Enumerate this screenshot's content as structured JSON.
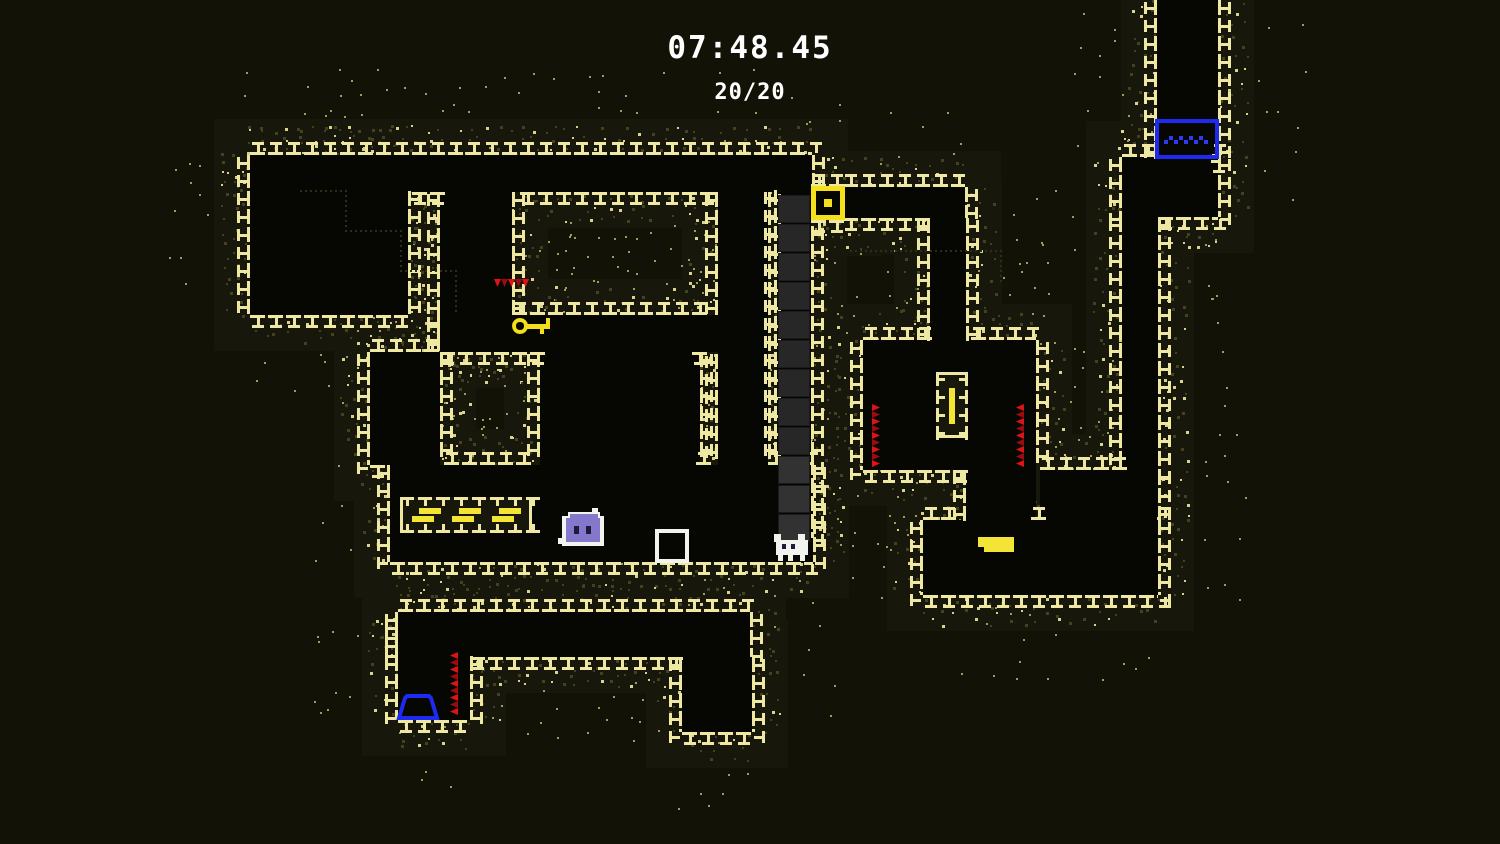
{
  "hud": {
    "timer": "07:48.45",
    "counter": "20/20"
  },
  "palette": {
    "bg": "#121207",
    "wall_fill": "#17170b",
    "room": "#060603",
    "brick": "#efe8a2",
    "dot_dim": "#424220",
    "dot_bright": "#d9d28c",
    "dot_outer": "#a29b5e",
    "accent_yellow": "#f4df1c",
    "bright_yellow": "#f4e435",
    "spike_red": "#dd1414",
    "spike_red_dark": "#9c0c0c",
    "blue": "#1c2af2",
    "blue_light": "#2b3cf4",
    "slime_purple": "#8478cc",
    "slime_eye": "#1c1c3a",
    "white": "#f2f2ee",
    "gray_block": "#272727",
    "gray_block_light": "#323232",
    "gray_block_edge": "#1a1a1a",
    "trail": "#2e2e16"
  },
  "render": {
    "width": 1500,
    "height": 844,
    "wall_margin": 36,
    "tile": 18,
    "seed": 7
  },
  "map": {
    "rooms": [
      {
        "name": "top-corridor",
        "x": 250,
        "y": 155,
        "w": 562,
        "h": 37
      },
      {
        "name": "top-left-room",
        "x": 250,
        "y": 155,
        "w": 158,
        "h": 160
      },
      {
        "name": "inner-corridor-down",
        "x": 440,
        "y": 192,
        "w": 72,
        "h": 160
      },
      {
        "name": "key-corridor",
        "x": 440,
        "y": 315,
        "w": 285,
        "h": 37
      },
      {
        "name": "center-room",
        "x": 540,
        "y": 352,
        "w": 160,
        "h": 113
      },
      {
        "name": "right-inner-corridor",
        "x": 718,
        "y": 192,
        "w": 50,
        "h": 273
      },
      {
        "name": "left-connector",
        "x": 370,
        "y": 352,
        "w": 70,
        "h": 113
      },
      {
        "name": "main-hall",
        "x": 390,
        "y": 465,
        "w": 423,
        "h": 97
      },
      {
        "name": "gray-shaft",
        "x": 777,
        "y": 190,
        "w": 34,
        "h": 348
      },
      {
        "name": "door-gap",
        "x": 811,
        "y": 187,
        "w": 34,
        "h": 33
      },
      {
        "name": "door-corridor",
        "x": 843,
        "y": 187,
        "w": 122,
        "h": 31
      },
      {
        "name": "down-shaft",
        "x": 930,
        "y": 218,
        "w": 36,
        "h": 125
      },
      {
        "name": "mid-right-room",
        "x": 863,
        "y": 340,
        "w": 173,
        "h": 130
      },
      {
        "name": "step-passage",
        "x": 966,
        "y": 470,
        "w": 70,
        "h": 73
      },
      {
        "name": "lower-corridor",
        "x": 398,
        "y": 612,
        "w": 352,
        "h": 45
      },
      {
        "name": "lower-left-room",
        "x": 398,
        "y": 620,
        "w": 72,
        "h": 100
      },
      {
        "name": "lower-pocket",
        "x": 682,
        "y": 657,
        "w": 70,
        "h": 75
      },
      {
        "name": "top-right-shaft",
        "x": 1157,
        "y": 0,
        "w": 61,
        "h": 160
      },
      {
        "name": "tr-transition",
        "x": 1122,
        "y": 157,
        "w": 96,
        "h": 60
      },
      {
        "name": "right-channel",
        "x": 1122,
        "y": 217,
        "w": 36,
        "h": 253
      },
      {
        "name": "br-room-upper",
        "x": 1040,
        "y": 470,
        "w": 118,
        "h": 50
      },
      {
        "name": "br-room",
        "x": 923,
        "y": 520,
        "w": 235,
        "h": 75
      }
    ],
    "trails": [
      {
        "name": "ghost-trail-1",
        "points": [
          [
            300,
            190
          ],
          [
            345,
            190
          ],
          [
            345,
            230
          ],
          [
            400,
            230
          ],
          [
            400,
            270
          ],
          [
            455,
            270
          ],
          [
            455,
            310
          ]
        ]
      },
      {
        "name": "ghost-trail-2",
        "points": [
          [
            850,
            250
          ],
          [
            1000,
            250
          ],
          [
            1000,
            282
          ]
        ]
      }
    ]
  },
  "entities": {
    "door_block": {
      "x": 811,
      "y": 186,
      "w": 34,
      "h": 34
    },
    "key": {
      "x": 512,
      "y": 316,
      "w": 38,
      "h": 20
    },
    "conveyor": {
      "x": 400,
      "y": 497,
      "w": 132,
      "h": 36
    },
    "slime": {
      "x": 562,
      "y": 512,
      "w": 42,
      "h": 36
    },
    "white_box": {
      "x": 655,
      "y": 529,
      "w": 34,
      "h": 34
    },
    "player": {
      "x": 774,
      "y": 534,
      "w": 38,
      "h": 28
    },
    "blue_hat": {
      "x": 397,
      "y": 694,
      "w": 42,
      "h": 26
    },
    "water_block": {
      "x": 1155,
      "y": 119,
      "w": 64,
      "h": 40
    },
    "pillar": {
      "x": 936,
      "y": 372,
      "w": 32,
      "h": 66
    },
    "bright_step": {
      "x": 978,
      "y": 537,
      "w": 36,
      "h": 15
    },
    "gray_blocks": {
      "x": 779,
      "y": 196,
      "w": 30,
      "h": 26,
      "gap": 3,
      "count": 12
    },
    "spikes": [
      {
        "dir": "down",
        "x": 494,
        "y": 279,
        "len": 38
      },
      {
        "dir": "right",
        "x": 872,
        "y": 404,
        "len": 64
      },
      {
        "dir": "left",
        "x": 1024,
        "y": 404,
        "len": 64
      },
      {
        "dir": "left",
        "x": 458,
        "y": 652,
        "len": 66
      }
    ]
  }
}
